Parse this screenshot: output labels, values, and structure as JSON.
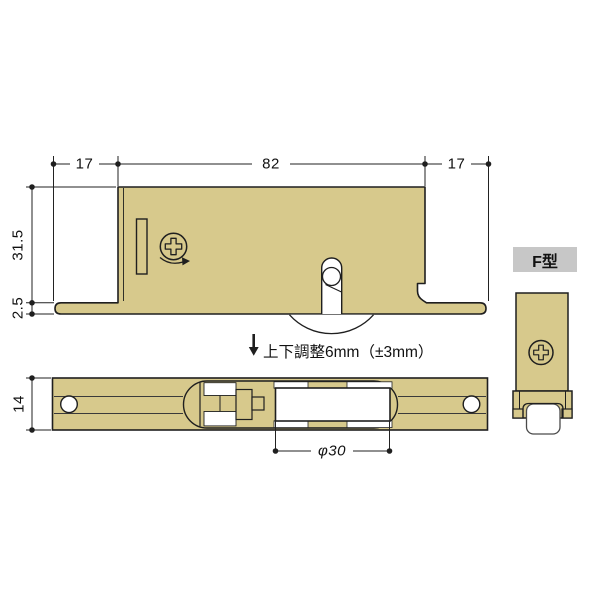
{
  "colors": {
    "body_tan": "#d7c98c",
    "outline": "#1f1f1f",
    "label_bg": "#c7c7c7",
    "background": "#ffffff"
  },
  "side_view": {
    "dim_top_left": "17",
    "dim_top_center": "82",
    "dim_top_right": "17",
    "dim_height": "31.5",
    "dim_lip_thickness": "2.5",
    "adjustment_note": "上下調整6mm（±3mm）"
  },
  "bottom_view": {
    "dim_plate_width": "14",
    "dim_roller_diameter": "φ30"
  },
  "end_view": {
    "type_label": "F型"
  }
}
